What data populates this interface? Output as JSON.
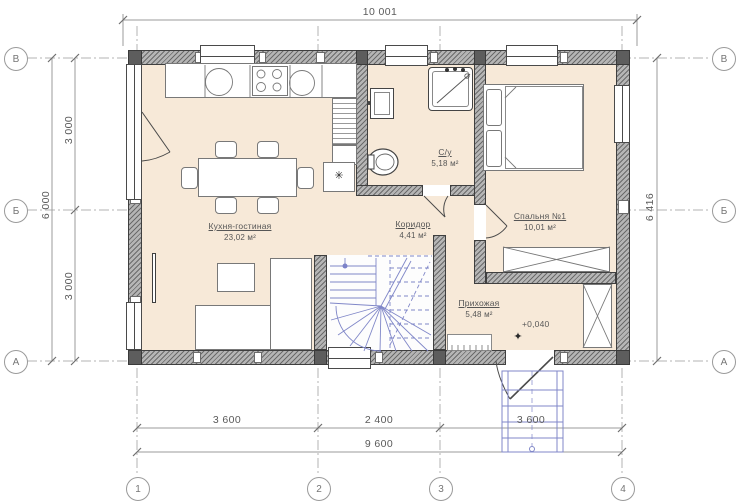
{
  "dimensions": {
    "top_width": "10 001",
    "left_outer_total": "6 000",
    "left_inner_upper": "3 000",
    "left_inner_lower": "3 000",
    "right_height": "6 416",
    "bottom_seg_1": "3 600",
    "bottom_seg_2": "2 400",
    "bottom_seg_3": "3 600",
    "bottom_total": "9 600"
  },
  "axes": {
    "row_labels": [
      "В",
      "Б",
      "А"
    ],
    "col_labels": [
      "1",
      "2",
      "3",
      "4"
    ]
  },
  "rooms": [
    {
      "name": "Кухня-гостиная",
      "area": "23,02 м²"
    },
    {
      "name": "С/у",
      "area": "5,18 м²"
    },
    {
      "name": "Коридор",
      "area": "4,41 м²"
    },
    {
      "name": "Спальня №1",
      "area": "10,01 м²"
    },
    {
      "name": "Прихожая",
      "area": "5,48 м²"
    }
  ],
  "elevation": {
    "value": "+0,040",
    "mark": "✦"
  },
  "symbols": {
    "fridge_snowflake": "✳"
  },
  "colors": {
    "floor": "#f7e9d8",
    "wall_fill": "#b5b5b5",
    "wall_line": "#3f3f3f",
    "stairs_blue": "#8087c8",
    "dim_text": "#5a5a5a"
  }
}
